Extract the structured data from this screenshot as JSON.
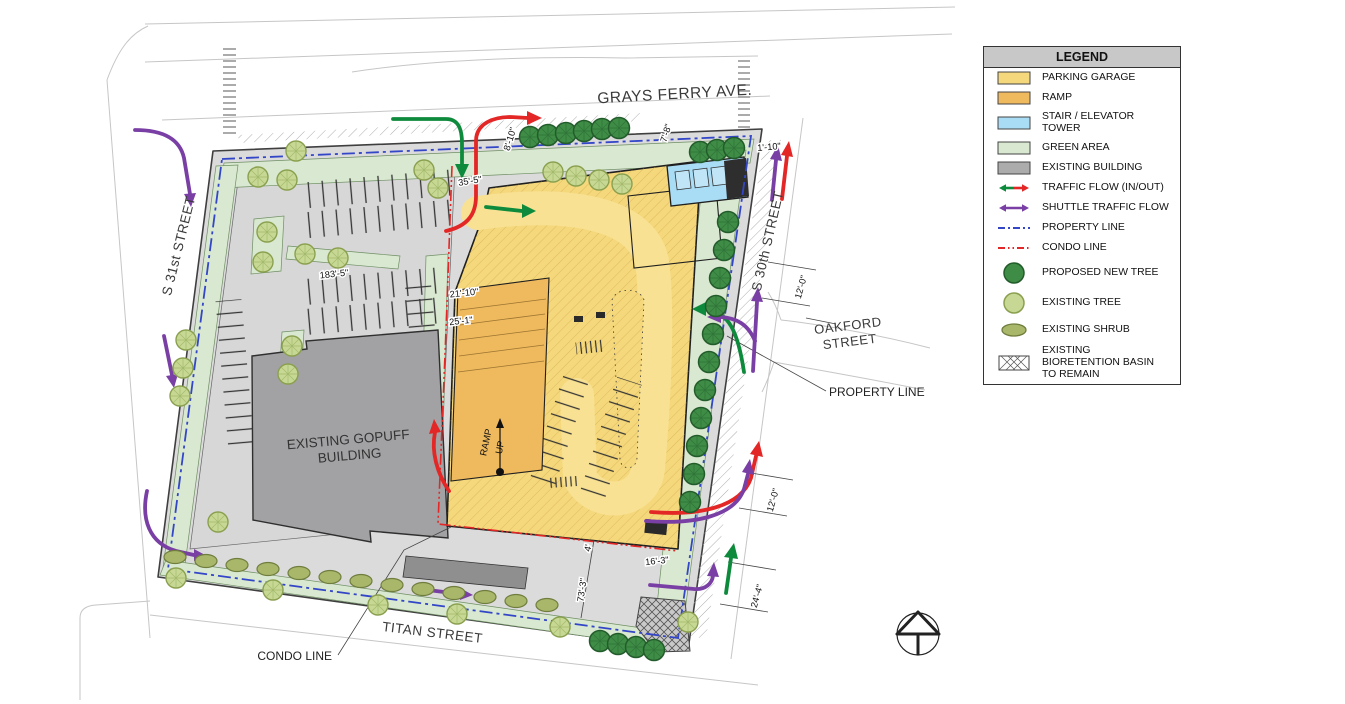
{
  "legend": {
    "title": "LEGEND",
    "items": [
      {
        "label": "PARKING GARAGE",
        "color": "#F5D87C"
      },
      {
        "label": "RAMP",
        "color": "#EFB95E"
      },
      {
        "label": "STAIR / ELEVATOR TOWER",
        "color": "#A9DCF5"
      },
      {
        "label": "GREEN AREA",
        "color": "#D9E8D0"
      },
      {
        "label": "EXISTING BUILDING",
        "color": "#ACACAC"
      },
      {
        "label": "TRAFFIC FLOW (IN/OUT)"
      },
      {
        "label": "SHUTTLE TRAFFIC FLOW"
      },
      {
        "label": "PROPERTY LINE"
      },
      {
        "label": "CONDO LINE"
      },
      {
        "label": "PROPOSED NEW TREE"
      },
      {
        "label": "EXISTING TREE"
      },
      {
        "label": "EXISTING SHRUB"
      },
      {
        "label": "EXISTING BIORETENTION BASIN TO REMAIN"
      }
    ]
  },
  "plan": {
    "streets": {
      "grays_ferry": "GRAYS FERRY AVE.",
      "s31": "S 31st STREET",
      "s30": "S 30th STREET",
      "oakford_l1": "OAKFORD",
      "oakford_l2": "STREET",
      "titan": "TITAN STREET"
    },
    "labels": {
      "building_l1": "EXISTING GOPUFF",
      "building_l2": "BUILDING",
      "property_line": "PROPERTY LINE",
      "condo_line": "CONDO LINE",
      "ramp_l1": "RAMP",
      "ramp_l2": "UP"
    },
    "dims": {
      "d8_10": "8'-10\"",
      "d35_5": "35'-5\"",
      "d7_8": "7'-8\"",
      "d1_10": "1'-10\"",
      "d183_5": "183'-5\"",
      "d21_10": "21'-10\"",
      "d25_1": "25'-1\"",
      "d12_0_a": "12'-0\"",
      "d12_0_b": "12'-0\"",
      "d16_3": "16'-3\"",
      "d4": "4'",
      "d73_3": "73'-3\"",
      "d24_4": "24'-4\""
    }
  },
  "colors": {
    "parking_garage": "#F5D87C",
    "ramp": "#EFB95E",
    "stair_tower": "#A9DCF5",
    "green_area": "#D9E8D0",
    "existing_building": "#A2A2A4",
    "traffic_green": "#0E8A3C",
    "traffic_red": "#E32726",
    "shuttle_purple": "#7A3FA5",
    "property_blue": "#3346C8",
    "condo_red": "#E32726",
    "tree_new": "#3E8C46",
    "tree_new_stroke": "#235C2B",
    "tree_existing": "#C6D893",
    "tree_existing_stroke": "#8AA04F",
    "shrub": "#A9B76A",
    "shrub_stroke": "#6F7E3E"
  }
}
